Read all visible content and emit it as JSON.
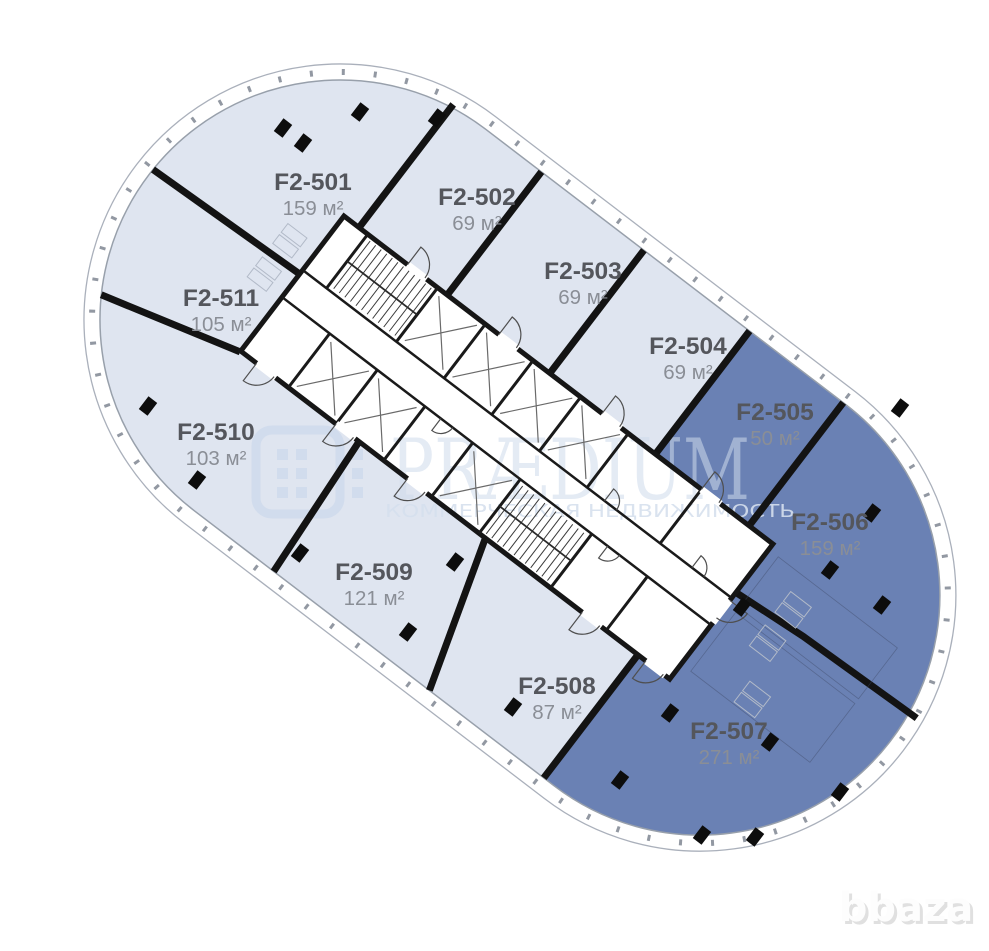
{
  "watermark": {
    "brand": "PRÆDIUM",
    "tagline": "КОММЕРЧЕСКАЯ НЕДВИЖИМОСТЬ",
    "site_mark": "bbaza"
  },
  "colors": {
    "unit_available": "#dfe5f0",
    "unit_selected": "#6a81b4",
    "wall": "#131313",
    "unit_name_text": "#54565c",
    "unit_area_text": "#8a8e96",
    "watermark_text": "#cfdbec"
  },
  "units": [
    {
      "name": "F2-501",
      "area": "159 м²",
      "status": "available"
    },
    {
      "name": "F2-502",
      "area": "69 м²",
      "status": "available"
    },
    {
      "name": "F2-503",
      "area": "69 м²",
      "status": "available"
    },
    {
      "name": "F2-504",
      "area": "69 м²",
      "status": "available"
    },
    {
      "name": "F2-505",
      "area": "50 м²",
      "status": "selected"
    },
    {
      "name": "F2-506",
      "area": "159 м²",
      "status": "selected"
    },
    {
      "name": "F2-507",
      "area": "271 м²",
      "status": "selected"
    },
    {
      "name": "F2-508",
      "area": "87 м²",
      "status": "available"
    },
    {
      "name": "F2-509",
      "area": "121 м²",
      "status": "available"
    },
    {
      "name": "F2-510",
      "area": "103 м²",
      "status": "available"
    },
    {
      "name": "F2-511",
      "area": "105 м²",
      "status": "available"
    }
  ]
}
